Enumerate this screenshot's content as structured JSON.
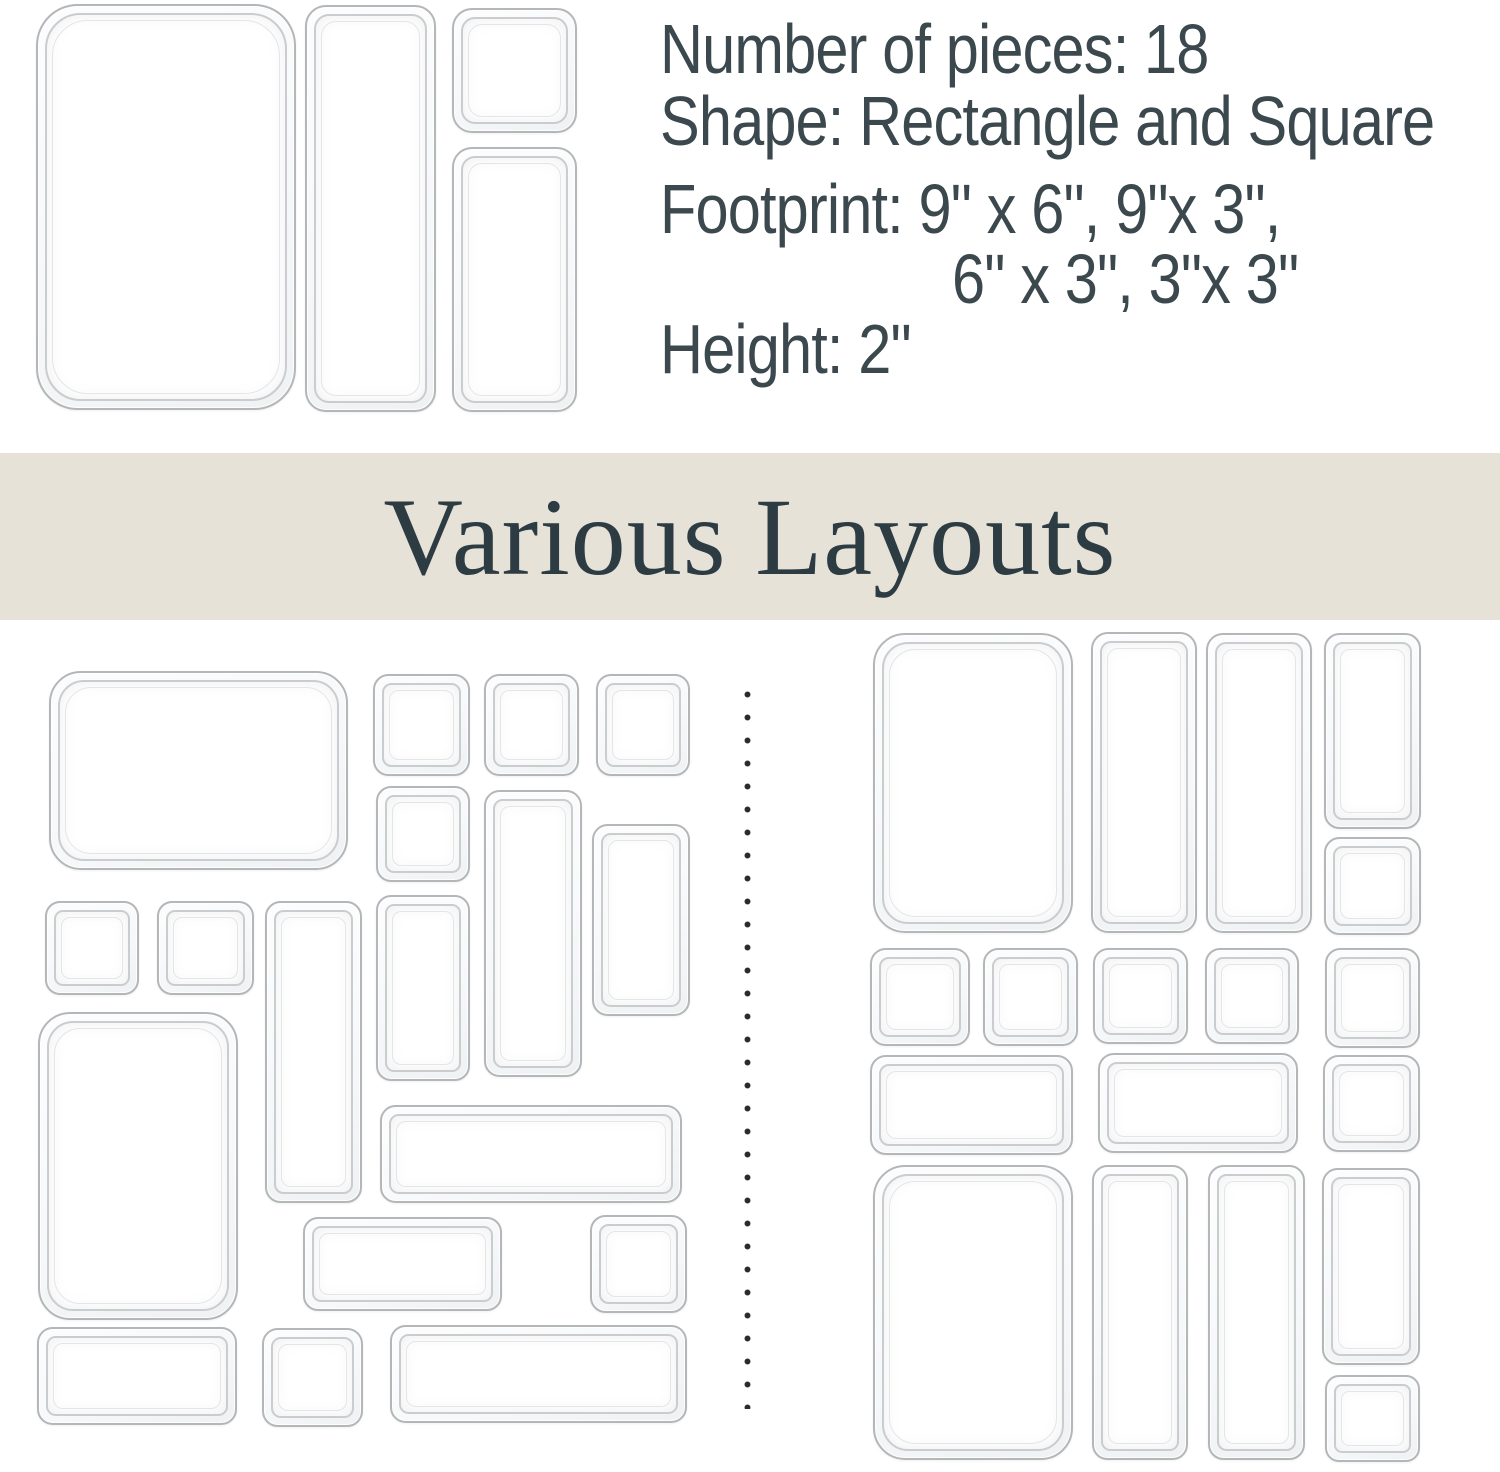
{
  "specs": {
    "line1": "Number of pieces: 18",
    "line2": "Shape: Rectangle and Square",
    "line3": "Footprint: 9\" x 6\", 9\"x 3\",",
    "line4": "6\" x 3\", 3\"x 3\"",
    "line5": "Height: 2\""
  },
  "banner": {
    "title": "Various Layouts"
  },
  "colors": {
    "banner_bg": "#e6e2d8",
    "banner_text": "#2d3c42",
    "text": "#3b484d",
    "tray_border": "#b3b7b9",
    "dot": "#2b2b2b"
  },
  "trays": {
    "top_set": [
      {
        "size": "9x6",
        "x": 36,
        "y": 4,
        "w": 260,
        "h": 406
      },
      {
        "size": "9x3",
        "x": 305,
        "y": 5,
        "w": 131,
        "h": 407
      },
      {
        "size": "3x3",
        "x": 452,
        "y": 8,
        "w": 125,
        "h": 125
      },
      {
        "size": "6x3",
        "x": 452,
        "y": 147,
        "w": 125,
        "h": 265
      }
    ],
    "layout_left": [
      {
        "size": "9x6",
        "x": 49,
        "y": 671,
        "w": 299,
        "h": 199
      },
      {
        "size": "3x3",
        "x": 373,
        "y": 674,
        "w": 97,
        "h": 102
      },
      {
        "size": "3x3",
        "x": 484,
        "y": 674,
        "w": 95,
        "h": 102
      },
      {
        "size": "3x3",
        "x": 596,
        "y": 674,
        "w": 94,
        "h": 102
      },
      {
        "size": "3x3",
        "x": 376,
        "y": 786,
        "w": 94,
        "h": 96
      },
      {
        "size": "9x3",
        "x": 484,
        "y": 790,
        "w": 98,
        "h": 287
      },
      {
        "size": "6x3",
        "x": 592,
        "y": 824,
        "w": 98,
        "h": 192
      },
      {
        "size": "3x3",
        "x": 45,
        "y": 901,
        "w": 94,
        "h": 94
      },
      {
        "size": "3x3",
        "x": 157,
        "y": 901,
        "w": 97,
        "h": 94
      },
      {
        "size": "9x3",
        "x": 265,
        "y": 901,
        "w": 97,
        "h": 302
      },
      {
        "size": "6x3",
        "x": 376,
        "y": 895,
        "w": 94,
        "h": 186
      },
      {
        "size": "9x6",
        "x": 38,
        "y": 1012,
        "w": 200,
        "h": 308
      },
      {
        "size": "9x3",
        "x": 380,
        "y": 1105,
        "w": 302,
        "h": 98
      },
      {
        "size": "6x3",
        "x": 303,
        "y": 1217,
        "w": 199,
        "h": 94
      },
      {
        "size": "3x3",
        "x": 590,
        "y": 1215,
        "w": 97,
        "h": 98
      },
      {
        "size": "6x3",
        "x": 37,
        "y": 1327,
        "w": 200,
        "h": 98
      },
      {
        "size": "3x3",
        "x": 262,
        "y": 1328,
        "w": 101,
        "h": 99
      },
      {
        "size": "9x3",
        "x": 390,
        "y": 1325,
        "w": 297,
        "h": 98
      }
    ],
    "layout_right": [
      {
        "size": "9x6",
        "x": 873,
        "y": 633,
        "w": 200,
        "h": 300
      },
      {
        "size": "9x3",
        "x": 1091,
        "y": 632,
        "w": 106,
        "h": 301
      },
      {
        "size": "9x3",
        "x": 1206,
        "y": 633,
        "w": 106,
        "h": 300
      },
      {
        "size": "6x3",
        "x": 1324,
        "y": 633,
        "w": 97,
        "h": 196
      },
      {
        "size": "3x3",
        "x": 1324,
        "y": 837,
        "w": 97,
        "h": 98
      },
      {
        "size": "3x3",
        "x": 870,
        "y": 948,
        "w": 100,
        "h": 98
      },
      {
        "size": "3x3",
        "x": 983,
        "y": 948,
        "w": 95,
        "h": 98
      },
      {
        "size": "3x3",
        "x": 1093,
        "y": 948,
        "w": 95,
        "h": 96
      },
      {
        "size": "3x3",
        "x": 1205,
        "y": 948,
        "w": 94,
        "h": 96
      },
      {
        "size": "3x3",
        "x": 1325,
        "y": 948,
        "w": 95,
        "h": 100
      },
      {
        "size": "6x3",
        "x": 870,
        "y": 1055,
        "w": 203,
        "h": 100
      },
      {
        "size": "6x3",
        "x": 1098,
        "y": 1053,
        "w": 200,
        "h": 100
      },
      {
        "size": "3x3",
        "x": 1323,
        "y": 1055,
        "w": 97,
        "h": 97
      },
      {
        "size": "9x6",
        "x": 873,
        "y": 1165,
        "w": 200,
        "h": 295
      },
      {
        "size": "9x3",
        "x": 1092,
        "y": 1165,
        "w": 96,
        "h": 295
      },
      {
        "size": "9x3",
        "x": 1208,
        "y": 1165,
        "w": 97,
        "h": 295
      },
      {
        "size": "6x3",
        "x": 1322,
        "y": 1168,
        "w": 98,
        "h": 197
      },
      {
        "size": "3x3",
        "x": 1325,
        "y": 1375,
        "w": 95,
        "h": 87
      }
    ]
  }
}
